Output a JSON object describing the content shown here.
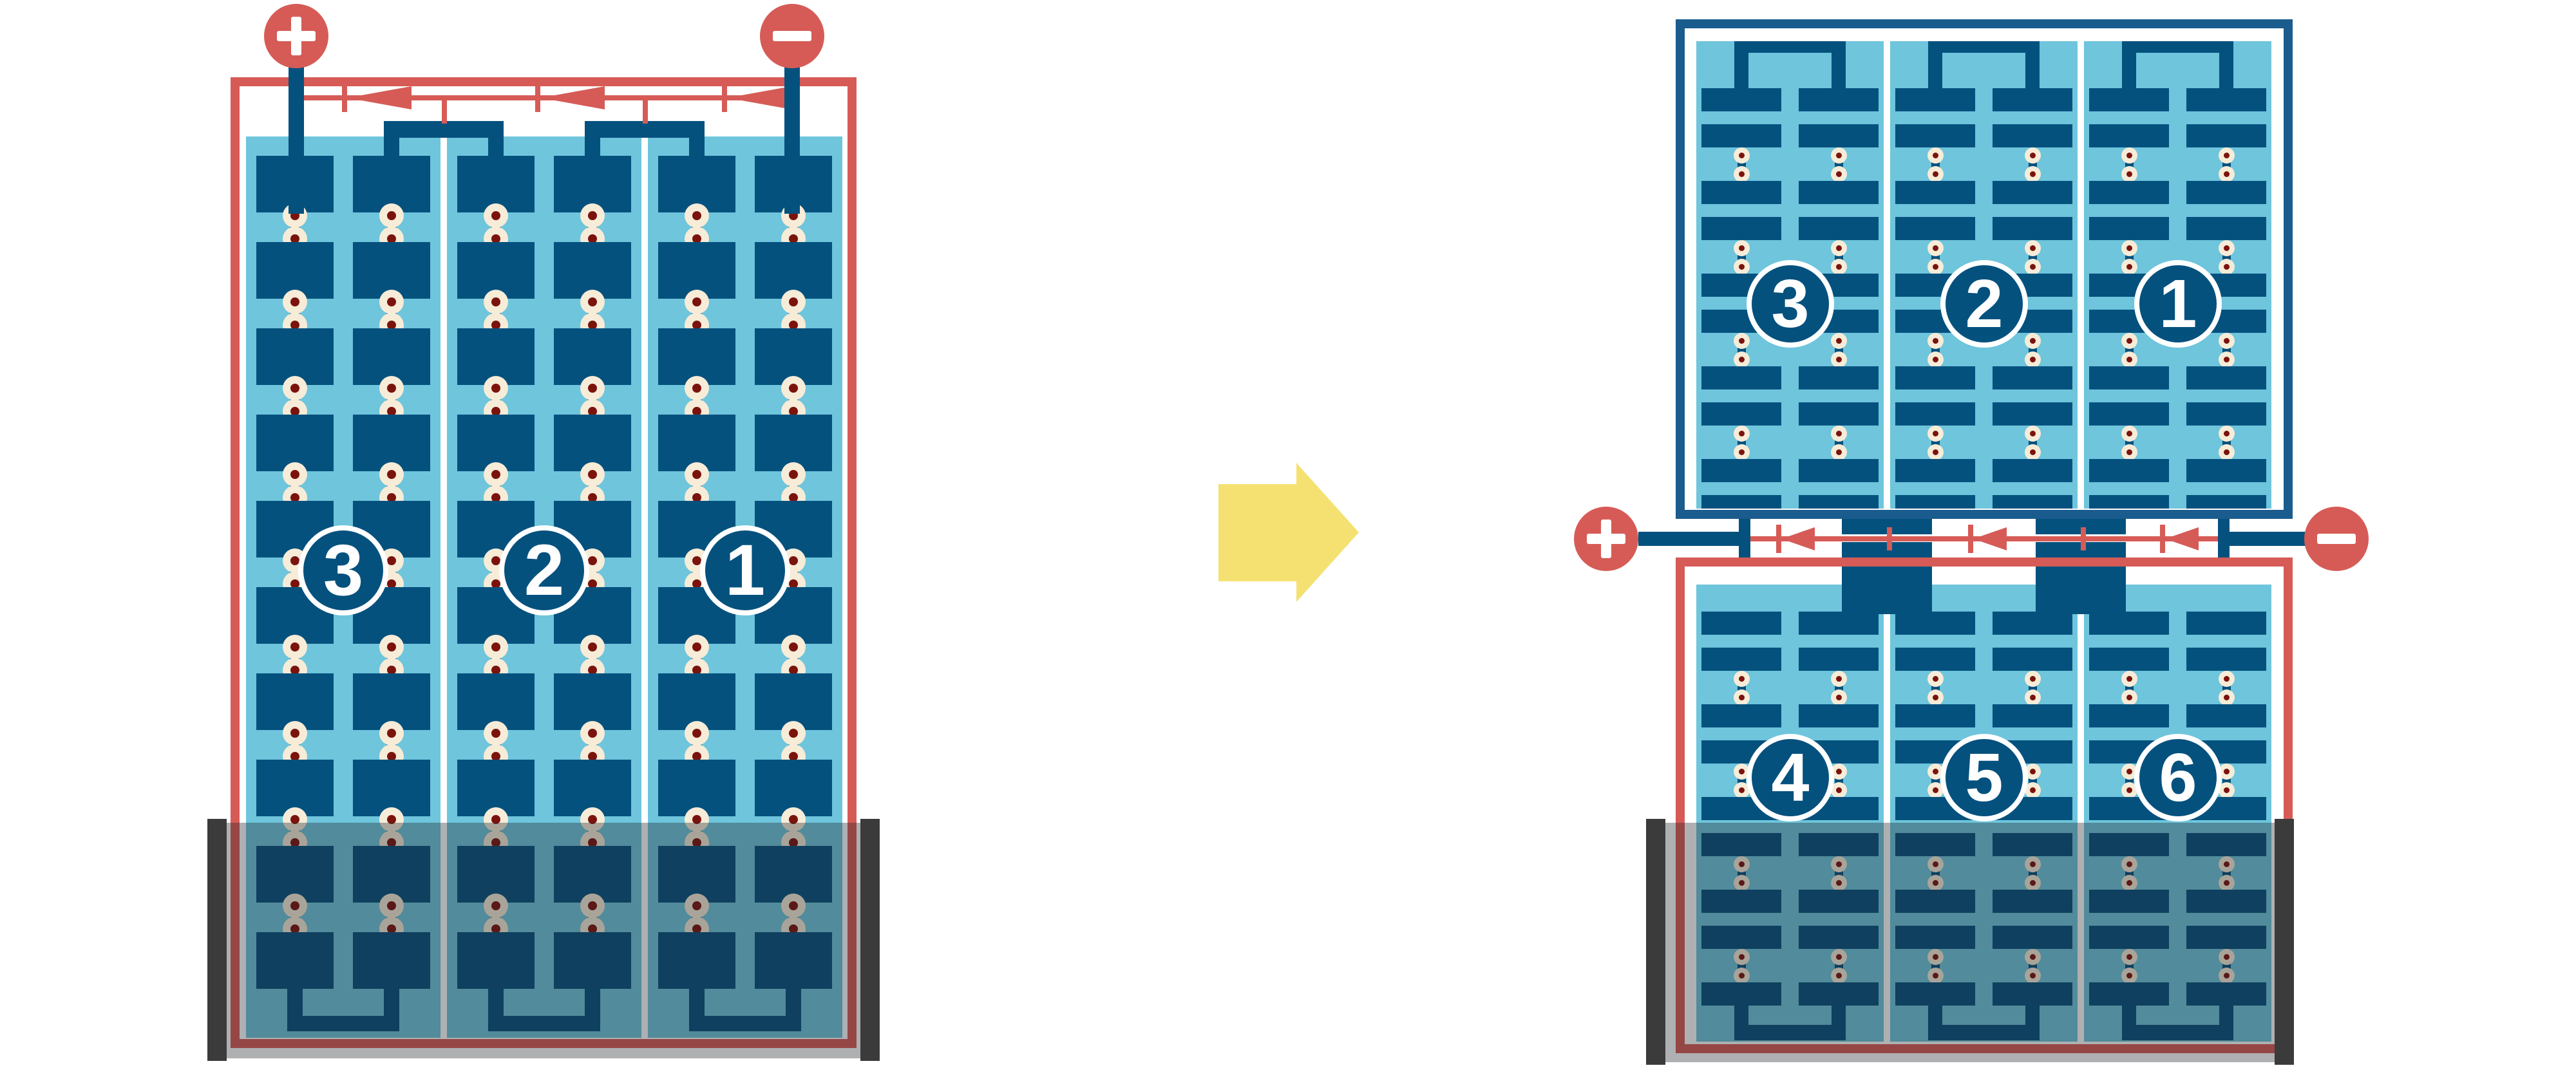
{
  "colors": {
    "module_frame_red": "#d65b56",
    "half_module_frame_blue": "#1a5c8e",
    "cell_dark_blue": "#05517e",
    "panel_light_blue": "#6ec5dc",
    "solder_dot_ring": "#f6ecd8",
    "solder_dot_core": "#7b130d",
    "shade_overlay": "rgba(33,37,41,0.36)",
    "shade_edge_bar": "#3b3b3b",
    "arrow_yellow": "#f4e172",
    "background": "#ffffff"
  },
  "left_module": {
    "terminals": [
      {
        "polarity": "positive",
        "symbol": "+"
      },
      {
        "polarity": "negative",
        "symbol": "−"
      }
    ],
    "bypass_diodes": 3,
    "strings": [
      {
        "label": "3"
      },
      {
        "label": "2"
      },
      {
        "label": "1"
      }
    ],
    "grid": {
      "strings": 3,
      "columns_per_string": 2,
      "cell_rows": 10
    },
    "shaded_region": "bottom"
  },
  "transform_arrow": {
    "direction": "right"
  },
  "right_module": {
    "terminals": [
      {
        "polarity": "positive",
        "symbol": "+"
      },
      {
        "polarity": "negative",
        "symbol": "−"
      }
    ],
    "bypass_diodes": 3,
    "top_panel": {
      "strings": [
        {
          "label": "3"
        },
        {
          "label": "2"
        },
        {
          "label": "1"
        }
      ],
      "grid": {
        "strings": 3,
        "columns_per_string": 2,
        "cell_rows": 10
      }
    },
    "bottom_panel": {
      "strings": [
        {
          "label": "4"
        },
        {
          "label": "5"
        },
        {
          "label": "6"
        }
      ],
      "grid": {
        "strings": 3,
        "columns_per_string": 2,
        "cell_rows": 9
      }
    },
    "shaded_region": "bottom"
  }
}
